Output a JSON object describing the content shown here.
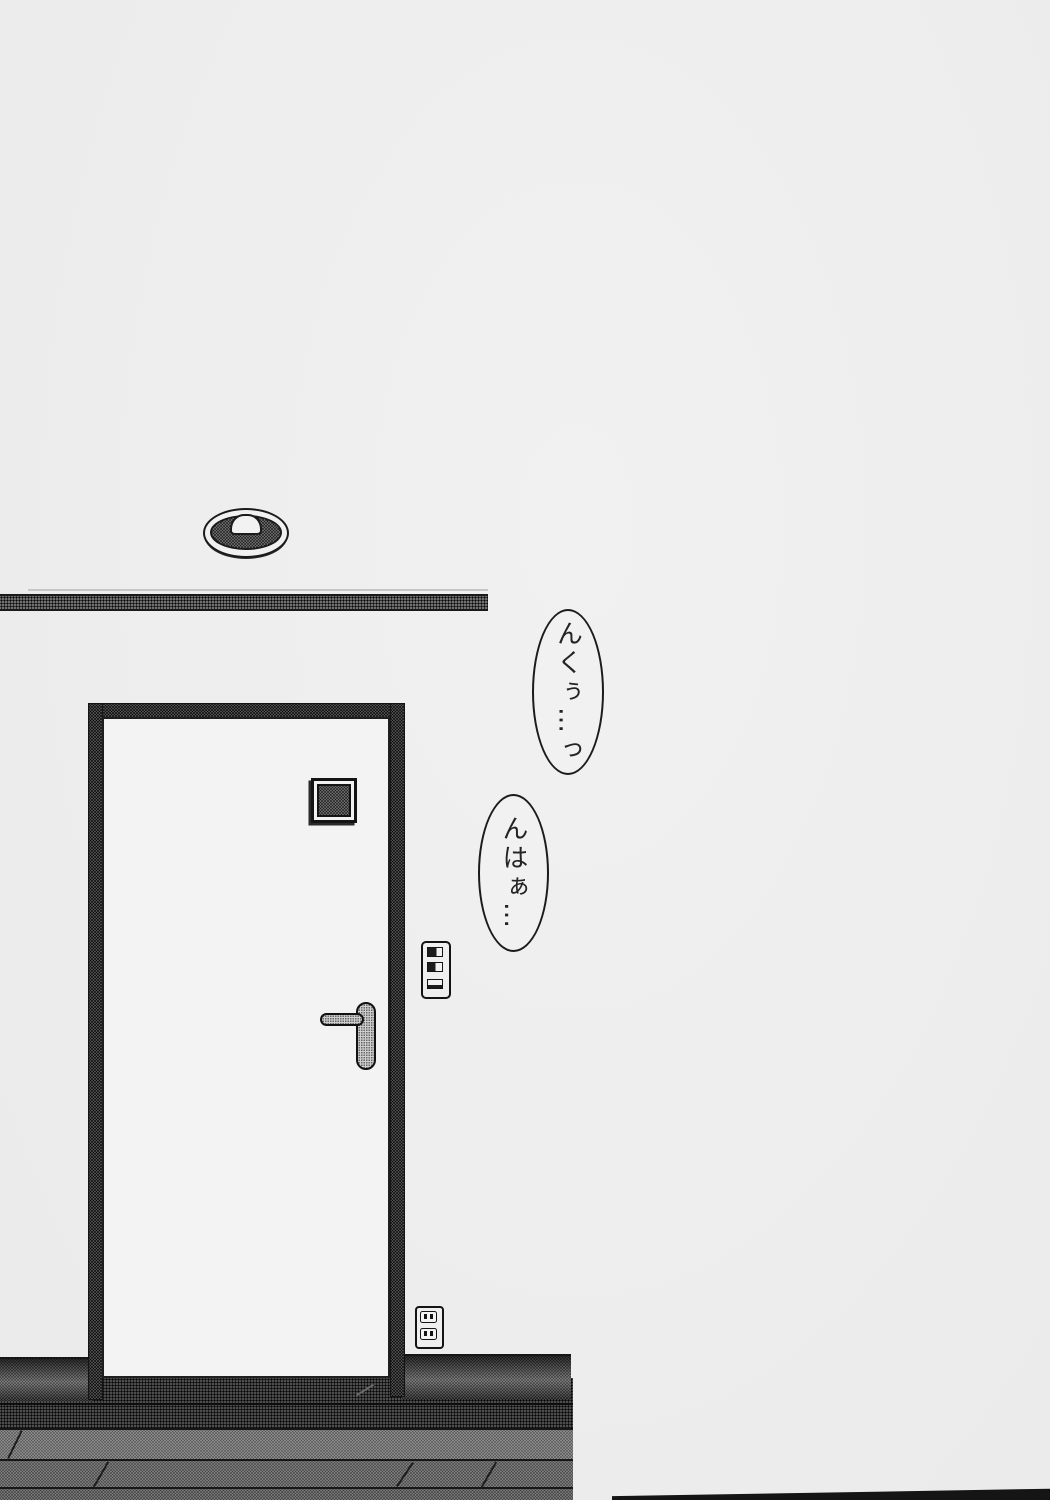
{
  "page": {
    "kind": "scanned manga page — interior scene with entrance door",
    "paper_color": "#eeeeee",
    "ink_color": "#1c1c1c"
  },
  "bubbles": [
    {
      "text": "んくぅ…っ"
    },
    {
      "text": "んはぁ…"
    }
  ],
  "scene": {
    "objects": [
      "ceiling-light",
      "wall-molding",
      "door-frame",
      "door",
      "peephole-window",
      "door-lever-handle",
      "light-switch-panel",
      "power-outlet",
      "baseboard",
      "wood-floor",
      "page-edge-shadow"
    ],
    "tones": {
      "frame_tone": "#8f8f8f",
      "floor_dark_tone": "#3c3c3c",
      "floor_light_tone": "#bdbdbd",
      "baseboard_tone": "#9a9a9a"
    }
  }
}
